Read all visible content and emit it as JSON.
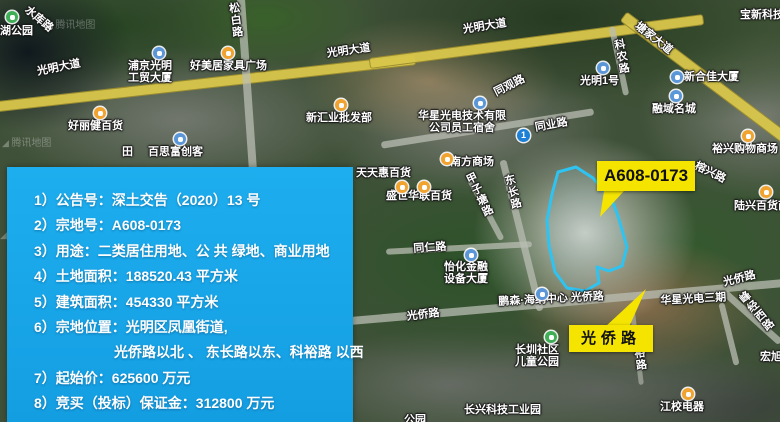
{
  "colors": {
    "panel_bg": "#18a6e9",
    "callout_bg": "#f4e400",
    "parcel_stroke": "#2fc3f2",
    "road_yellow": "#d9c74b"
  },
  "callout_parcel": {
    "label": "A608-0173"
  },
  "callout_road": {
    "label": "光侨路"
  },
  "panel": {
    "lines": [
      {
        "text": "1）公告号：深土交告（2020）13 号"
      },
      {
        "text": "2）宗地号：A608-0173"
      },
      {
        "text": "3）用途：二类居住用地、公 共 绿地、商业用地"
      },
      {
        "text": "4）土地面积：188520.43 平方米"
      },
      {
        "text": "5）建筑面积：454330 平方米"
      },
      {
        "text": "6）宗地位置：光明区凤凰街道,"
      },
      {
        "text": "光侨路以北 、 东长路以东、科裕路 以西",
        "indent": true
      },
      {
        "text": "7）起始价：625600 万元"
      },
      {
        "text": "8）竞买（投标）保证金：312800 万元"
      }
    ]
  },
  "map": {
    "watermark": "腾讯地图",
    "watermarks": [
      {
        "x": 46,
        "y": 16
      },
      {
        "x": 2,
        "y": 134
      },
      {
        "x": 0,
        "y": 226
      }
    ],
    "labels": [
      {
        "t": "湖公园",
        "x": 0,
        "y": 25
      },
      {
        "t": "水库路",
        "x": 30,
        "y": 4,
        "r": 40
      },
      {
        "t": "松白路",
        "x": 227,
        "y": 3,
        "v": 1,
        "r": -7
      },
      {
        "t": "光明大道",
        "x": 36,
        "y": 66,
        "r": -11
      },
      {
        "t": "浦京光明",
        "t2": "工贸大厦",
        "x": 128,
        "y": 60
      },
      {
        "t": "好美居家具广场",
        "x": 190,
        "y": 60
      },
      {
        "t": "光明大道",
        "x": 326,
        "y": 48,
        "r": -8
      },
      {
        "t": "好丽健百货",
        "x": 68,
        "y": 120
      },
      {
        "t": "百思富创客",
        "x": 148,
        "y": 146
      },
      {
        "t": "田",
        "x": 122,
        "y": 146
      },
      {
        "t": "新汇业批发部",
        "x": 306,
        "y": 112
      },
      {
        "t": "光明大道",
        "x": 462,
        "y": 24,
        "r": -9
      },
      {
        "t": "塘家大道",
        "x": 640,
        "y": 20,
        "r": 38
      },
      {
        "t": "宝新科技",
        "x": 740,
        "y": 9
      },
      {
        "t": "科农路",
        "x": 612,
        "y": 40,
        "v": 1,
        "r": -10
      },
      {
        "t": "光明1号",
        "x": 580,
        "y": 75
      },
      {
        "t": "新合佳大厦",
        "x": 684,
        "y": 71
      },
      {
        "t": "融域名城",
        "x": 652,
        "y": 103
      },
      {
        "t": "同观路",
        "x": 492,
        "y": 88,
        "r": -27
      },
      {
        "t": "华星光电技术有限",
        "t2": "公司员工宿舍",
        "x": 418,
        "y": 110
      },
      {
        "t": "同业路",
        "x": 534,
        "y": 122,
        "r": -10
      },
      {
        "t": "裕兴购物商场",
        "x": 712,
        "y": 143
      },
      {
        "t": "榕兴路",
        "x": 698,
        "y": 160,
        "r": 26
      },
      {
        "t": "陆兴百货商场",
        "x": 734,
        "y": 200
      },
      {
        "t": "天天惠百货",
        "x": 356,
        "y": 167
      },
      {
        "t": "盛世华联百货",
        "x": 386,
        "y": 190
      },
      {
        "t": "南方商场",
        "x": 450,
        "y": 156
      },
      {
        "t": "东长路",
        "x": 502,
        "y": 176,
        "v": 1,
        "r": -14
      },
      {
        "t": "甲子塘路",
        "x": 463,
        "y": 176,
        "v": 1,
        "r": -26
      },
      {
        "t": "同仁路",
        "x": 413,
        "y": 243,
        "r": -4
      },
      {
        "t": "怡化金融",
        "t2": "设备大厦",
        "x": 444,
        "y": 261
      },
      {
        "t": "鹏森·海纳中心 光侨路",
        "x": 498,
        "y": 296,
        "r": -3
      },
      {
        "t": "光侨路",
        "x": 406,
        "y": 311,
        "r": -7
      },
      {
        "t": "长圳社区",
        "t2": "儿童公园",
        "x": 515,
        "y": 344
      },
      {
        "t": "长兴科技工业园",
        "x": 464,
        "y": 404
      },
      {
        "t": "公园",
        "x": 404,
        "y": 414
      },
      {
        "t": "光侨路",
        "x": 722,
        "y": 277,
        "r": -14
      },
      {
        "t": "华星光电三期",
        "x": 660,
        "y": 295,
        "r": -3
      },
      {
        "t": "峰经西路",
        "x": 736,
        "y": 297,
        "v": 1,
        "r": -40
      },
      {
        "t": "裕路",
        "x": 632,
        "y": 348,
        "v": 1,
        "r": -8
      },
      {
        "t": "宏旭大厦",
        "x": 760,
        "y": 351
      },
      {
        "t": "江校电器",
        "x": 660,
        "y": 401
      }
    ],
    "pois": [
      {
        "type": "park",
        "x": 6,
        "y": 11
      },
      {
        "type": "building",
        "x": 153,
        "y": 47
      },
      {
        "type": "shop",
        "x": 222,
        "y": 47
      },
      {
        "type": "shop",
        "x": 94,
        "y": 107
      },
      {
        "type": "building",
        "x": 174,
        "y": 133
      },
      {
        "type": "shop",
        "x": 335,
        "y": 99
      },
      {
        "type": "building",
        "x": 597,
        "y": 62
      },
      {
        "type": "building",
        "x": 671,
        "y": 71
      },
      {
        "type": "building",
        "x": 670,
        "y": 90
      },
      {
        "type": "building",
        "x": 474,
        "y": 97
      },
      {
        "type": "metro",
        "x": 517,
        "y": 129
      },
      {
        "type": "shop",
        "x": 742,
        "y": 130
      },
      {
        "type": "shop",
        "x": 760,
        "y": 186
      },
      {
        "type": "shop",
        "x": 396,
        "y": 181
      },
      {
        "type": "shop",
        "x": 418,
        "y": 181
      },
      {
        "type": "shop",
        "x": 441,
        "y": 153
      },
      {
        "type": "building",
        "x": 465,
        "y": 249
      },
      {
        "type": "building",
        "x": 536,
        "y": 288
      },
      {
        "type": "park",
        "x": 545,
        "y": 331
      },
      {
        "type": "shop",
        "x": 682,
        "y": 388
      }
    ]
  }
}
